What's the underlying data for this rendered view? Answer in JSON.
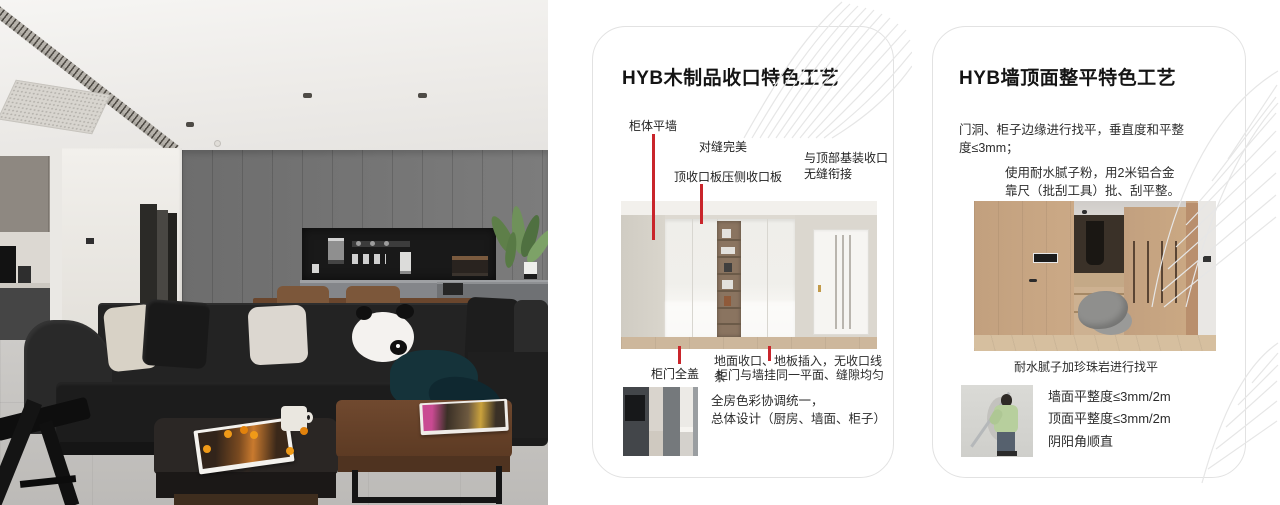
{
  "accent_red": "#c9252b",
  "cards": [
    {
      "title": "HYB木制品收口特色工艺",
      "callouts": [
        "柜体平墙",
        "对缝完美",
        "顶收口板压侧收口板",
        "与顶部基装收口\n无缝衔接",
        "柜门全盖"
      ],
      "notes": [
        "地面收口、地板插入，无收口线条",
        "柜门与墙挂同一平面、缝隙均匀"
      ],
      "summary": [
        "全房色彩协调统一，",
        "总体设计（厨房、墙面、柜子）"
      ]
    },
    {
      "title": "HYB墙顶面整平特色工艺",
      "paragraphs": [
        "门洞、柜子边缘进行找平，垂直度和平整\n度≤3mm；",
        "使用耐水腻子粉，用2米铝合金\n靠尺（批刮工具）批、刮平整。"
      ],
      "caption": "耐水腻子加珍珠岩进行找平",
      "list": [
        "墙面平整度≤3mm/2m",
        "顶面平整度≤3mm/2m",
        "阴阳角顺直"
      ]
    }
  ]
}
